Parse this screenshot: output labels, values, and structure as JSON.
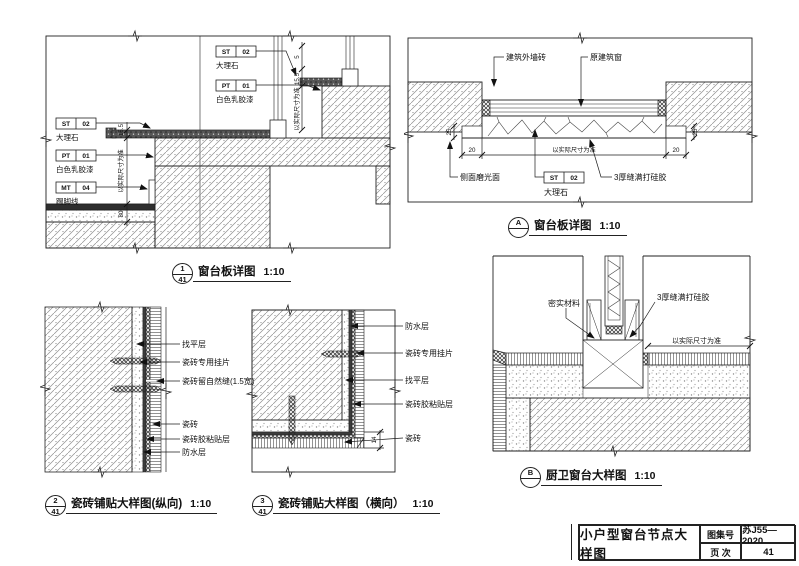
{
  "sheet": {
    "title": "小户型窗台节点大样图",
    "atlas_label": "图集号",
    "atlas_value": "苏J55—2020",
    "page_label": "页 次",
    "page_value": "41"
  },
  "d1": {
    "badge_top": "1",
    "badge_bottom": "41",
    "title": "窗台板详图",
    "scale": "1:10",
    "st_code": "ST",
    "st_no": "02",
    "st_name": "大理石",
    "pt_code": "PT",
    "pt_no": "01",
    "pt_name": "白色乳胶漆",
    "mt_code": "MT",
    "mt_no": "04",
    "mt_name": "踢脚线",
    "dim_actual": "以实际尺寸为准",
    "dim_5": "5",
    "dim_155": "15.5",
    "dim_80": "80"
  },
  "dA": {
    "badge_top": "A",
    "badge_bottom": "",
    "title": "窗台板详图",
    "scale": "1:10",
    "ext_wall_tile": "建筑外墙砖",
    "orig_window": "原建筑窗",
    "side_polish": "侧面磨光面",
    "sealant": "3厚缝满打硅胶",
    "st_code": "ST",
    "st_no": "02",
    "st_name": "大理石",
    "dim_actual": "以实际尺寸为准",
    "dim_20": "20",
    "dim_25": "25"
  },
  "d2": {
    "badge_top": "2",
    "badge_bottom": "41",
    "title": "瓷砖铺贴大样图(纵向)",
    "scale": "1:10",
    "leveling": "找平层",
    "clip": "瓷砖专用挂片",
    "seam": "瓷砖留自然缝(1.5宽)",
    "tile": "瓷砖",
    "adhesive": "瓷砖胶粘贴层",
    "waterproof": "防水层"
  },
  "d3": {
    "badge_top": "3",
    "badge_bottom": "41",
    "title": "瓷砖铺贴大样图（横向）",
    "scale": "1:10",
    "waterproof": "防水层",
    "clip": "瓷砖专用挂片",
    "leveling": "找平层",
    "adhesive": "瓷砖胶粘贴层",
    "tile": "瓷砖",
    "dim_14": "14"
  },
  "dB": {
    "badge_top": "B",
    "badge_bottom": "",
    "title": "厨卫窗台大样图",
    "scale": "1:10",
    "filler": "密实材料",
    "sealant": "3厚缝满打硅胶",
    "dim_actual": "以实际尺寸为准"
  }
}
